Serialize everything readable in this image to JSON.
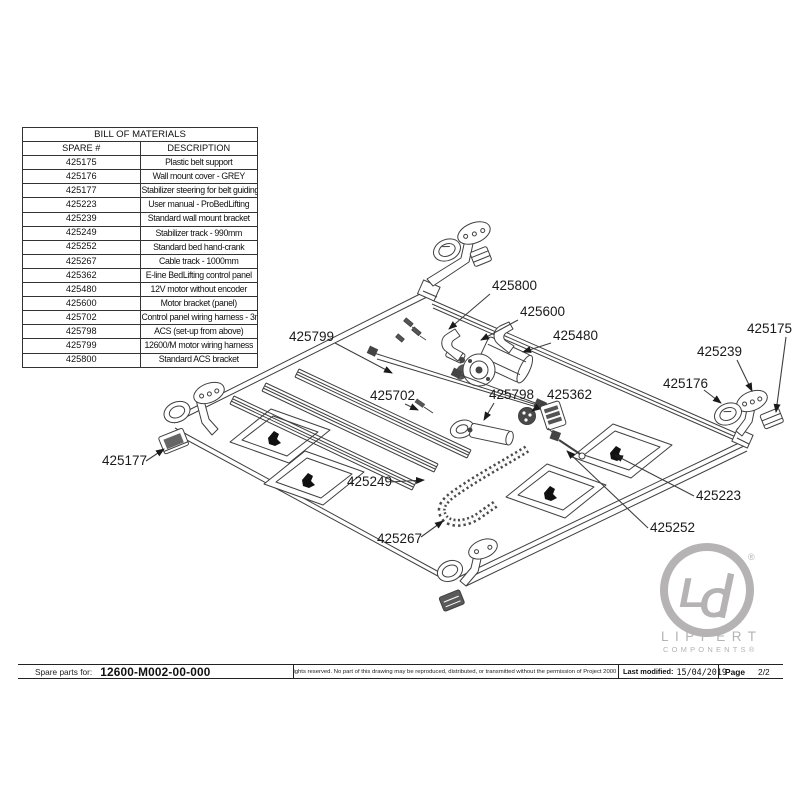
{
  "bom_table": {
    "title": "BILL OF MATERIALS",
    "columns": {
      "spare": "SPARE #",
      "description": "DESCRIPTION"
    },
    "rows": [
      {
        "spare": "425175",
        "description": "Plastic belt support"
      },
      {
        "spare": "425176",
        "description": "Wall mount cover - GREY"
      },
      {
        "spare": "425177",
        "description": "Stabilizer steering for belt guiding trolley"
      },
      {
        "spare": "425223",
        "description": "User manual - ProBedLifting"
      },
      {
        "spare": "425239",
        "description": "Standard wall mount bracket"
      },
      {
        "spare": "425249",
        "description": "Stabilizer track - 990mm"
      },
      {
        "spare": "425252",
        "description": "Standard bed hand-crank"
      },
      {
        "spare": "425267",
        "description": "Cable track - 1000mm"
      },
      {
        "spare": "425362",
        "description": "E-line BedLifting control panel"
      },
      {
        "spare": "425480",
        "description": "12V motor without encoder"
      },
      {
        "spare": "425600",
        "description": "Motor bracket (panel)"
      },
      {
        "spare": "425702",
        "description": "Control panel wiring harness - 3m"
      },
      {
        "spare": "425798",
        "description": "ACS (set-up from above)"
      },
      {
        "spare": "425799",
        "description": "12600/M motor wiring harness"
      },
      {
        "spare": "425800",
        "description": "Standard ACS bracket"
      }
    ]
  },
  "diagram": {
    "line_color": "#3f3f3f",
    "callouts": [
      {
        "label": "425799",
        "tx": 289,
        "ty": 341,
        "x1": 335,
        "y1": 343,
        "x2": 392,
        "y2": 373
      },
      {
        "label": "425800",
        "tx": 492,
        "ty": 290,
        "x1": 490,
        "y1": 294,
        "x2": 449,
        "y2": 329
      },
      {
        "label": "425600",
        "tx": 520,
        "ty": 316,
        "x1": 518,
        "y1": 320,
        "x2": 481,
        "y2": 340
      },
      {
        "label": "425480",
        "tx": 553,
        "ty": 340,
        "x1": 551,
        "y1": 343,
        "x2": 523,
        "y2": 352
      },
      {
        "label": "425702",
        "tx": 370,
        "ty": 400,
        "x1": 405,
        "y1": 404,
        "x2": 418,
        "y2": 410
      },
      {
        "label": "425798",
        "tx": 489,
        "ty": 399,
        "x1": 494,
        "y1": 403,
        "x2": 484,
        "y2": 420
      },
      {
        "label": "425362",
        "tx": 547,
        "ty": 399,
        "x1": 545,
        "y1": 402,
        "x2": 532,
        "y2": 411
      },
      {
        "label": "425175",
        "tx": 747,
        "ty": 333,
        "x1": 786,
        "y1": 337,
        "x2": 776,
        "y2": 412
      },
      {
        "label": "425239",
        "tx": 697,
        "ty": 356,
        "x1": 737,
        "y1": 360,
        "x2": 752,
        "y2": 391
      },
      {
        "label": "425176",
        "tx": 663,
        "ty": 388,
        "x1": 704,
        "y1": 390,
        "x2": 721,
        "y2": 403
      },
      {
        "label": "425177",
        "tx": 102,
        "ty": 465,
        "x1": 146,
        "y1": 461,
        "x2": 164,
        "y2": 449
      },
      {
        "label": "425249",
        "tx": 347,
        "ty": 486,
        "x1": 390,
        "y1": 482,
        "x2": 424,
        "y2": 480
      },
      {
        "label": "425267",
        "tx": 377,
        "ty": 543,
        "x1": 421,
        "y1": 537,
        "x2": 443,
        "y2": 521
      },
      {
        "label": "425223",
        "tx": 696,
        "ty": 500,
        "x1": 694,
        "y1": 496,
        "x2": 615,
        "y2": 455
      },
      {
        "label": "425252",
        "tx": 650,
        "ty": 532,
        "x1": 648,
        "y1": 528,
        "x2": 567,
        "y2": 451
      }
    ]
  },
  "footer": {
    "spare_parts_label": "Spare parts for:",
    "part_number": "12600-M002-00-000",
    "rights_text": "All rights reserved. No part of this drawing may be reproduced, distributed, or transmitted without the permission of Project 2000 s.r.l.",
    "last_modified_label": "Last modified:",
    "last_modified_value": "15/04/2019",
    "page_label": "Page",
    "page_value": "2/2"
  },
  "logo": {
    "monogram_l": "L",
    "monogram_c": "C",
    "registered": "®",
    "name": "LIPPERT",
    "subname": "COMPONENTS®",
    "color": "#b5b3b3"
  }
}
